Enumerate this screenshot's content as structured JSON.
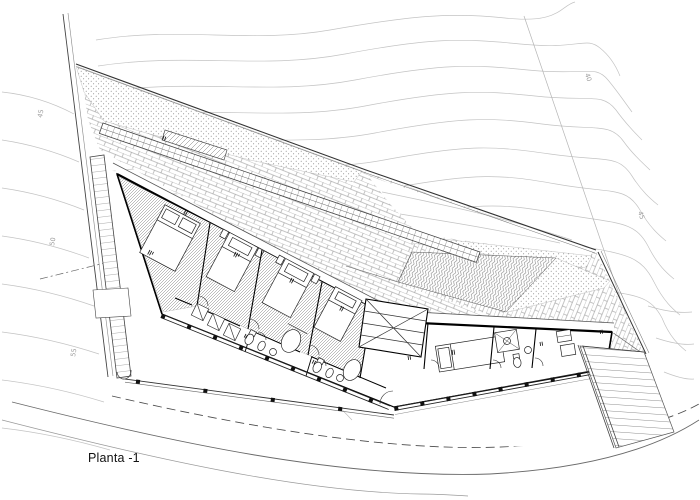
{
  "plan": {
    "title": "Planta -1"
  },
  "elevation_labels": [
    {
      "text": "45",
      "x": 42,
      "y": 118,
      "rotate": -80
    },
    {
      "text": "50",
      "x": 54,
      "y": 246,
      "rotate": -80
    },
    {
      "text": "55",
      "x": 75,
      "y": 357,
      "rotate": -80
    },
    {
      "text": "40",
      "x": 585,
      "y": 74,
      "rotate": 72
    },
    {
      "text": "45",
      "x": 638,
      "y": 212,
      "rotate": 72
    }
  ],
  "colors": {
    "paper": "#ffffff",
    "ink": "#1a1a1a",
    "mid": "#555555",
    "contour": "#c3c3c3",
    "hatch": "#888888"
  }
}
